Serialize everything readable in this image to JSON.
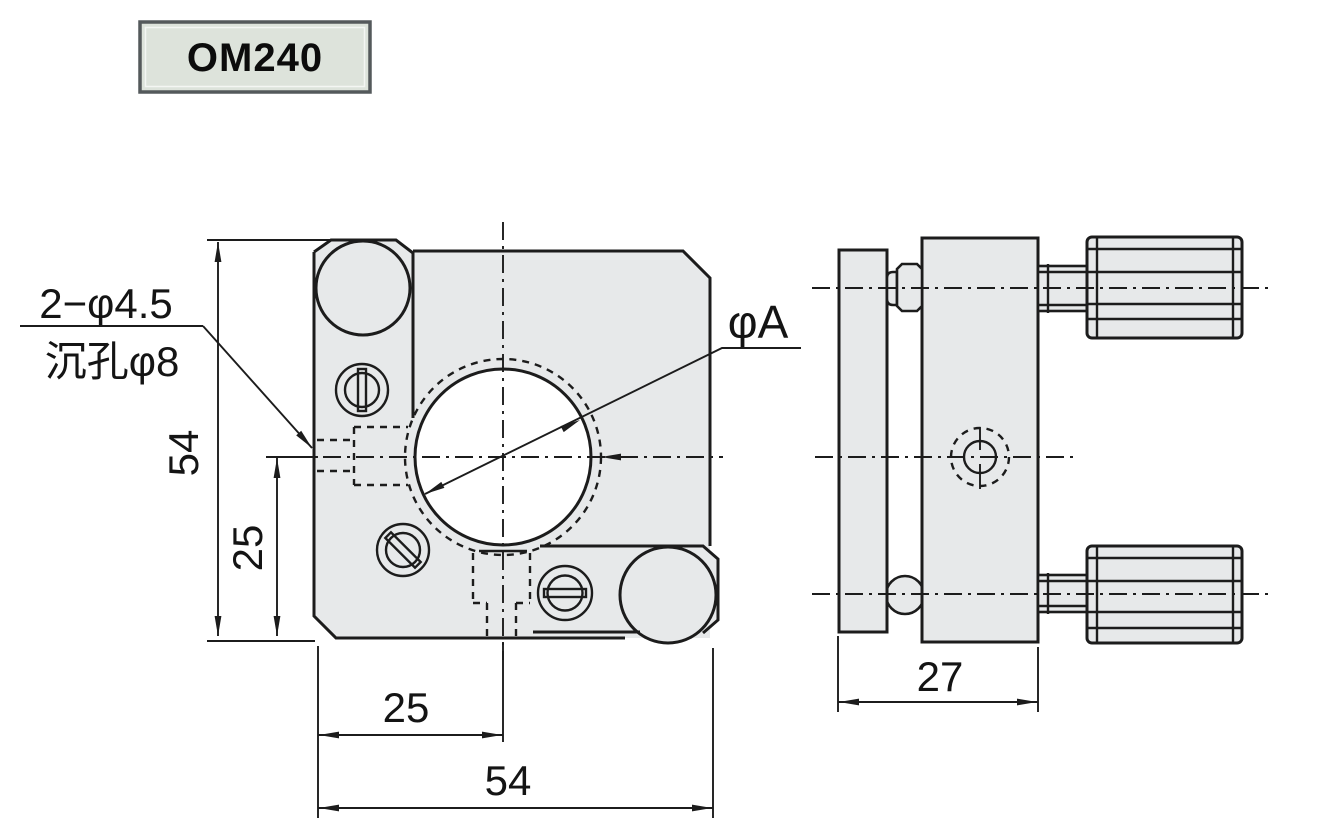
{
  "title_block": {
    "model": "OM240"
  },
  "front_view": {
    "note": {
      "line1": "2−φ4.5",
      "line2": "沉孔φ8"
    },
    "aperture_label": "φA",
    "dim_height": "54",
    "dim_center_from_bottom": "25",
    "dim_center_from_left": "25",
    "dim_width": "54"
  },
  "side_view": {
    "dim_depth": "27"
  },
  "colors": {
    "part_fill": "#e7e9ea",
    "drawing_line": "#1c1c1c",
    "label_box_background": "#dde3db",
    "label_box_border": "#54595b"
  }
}
